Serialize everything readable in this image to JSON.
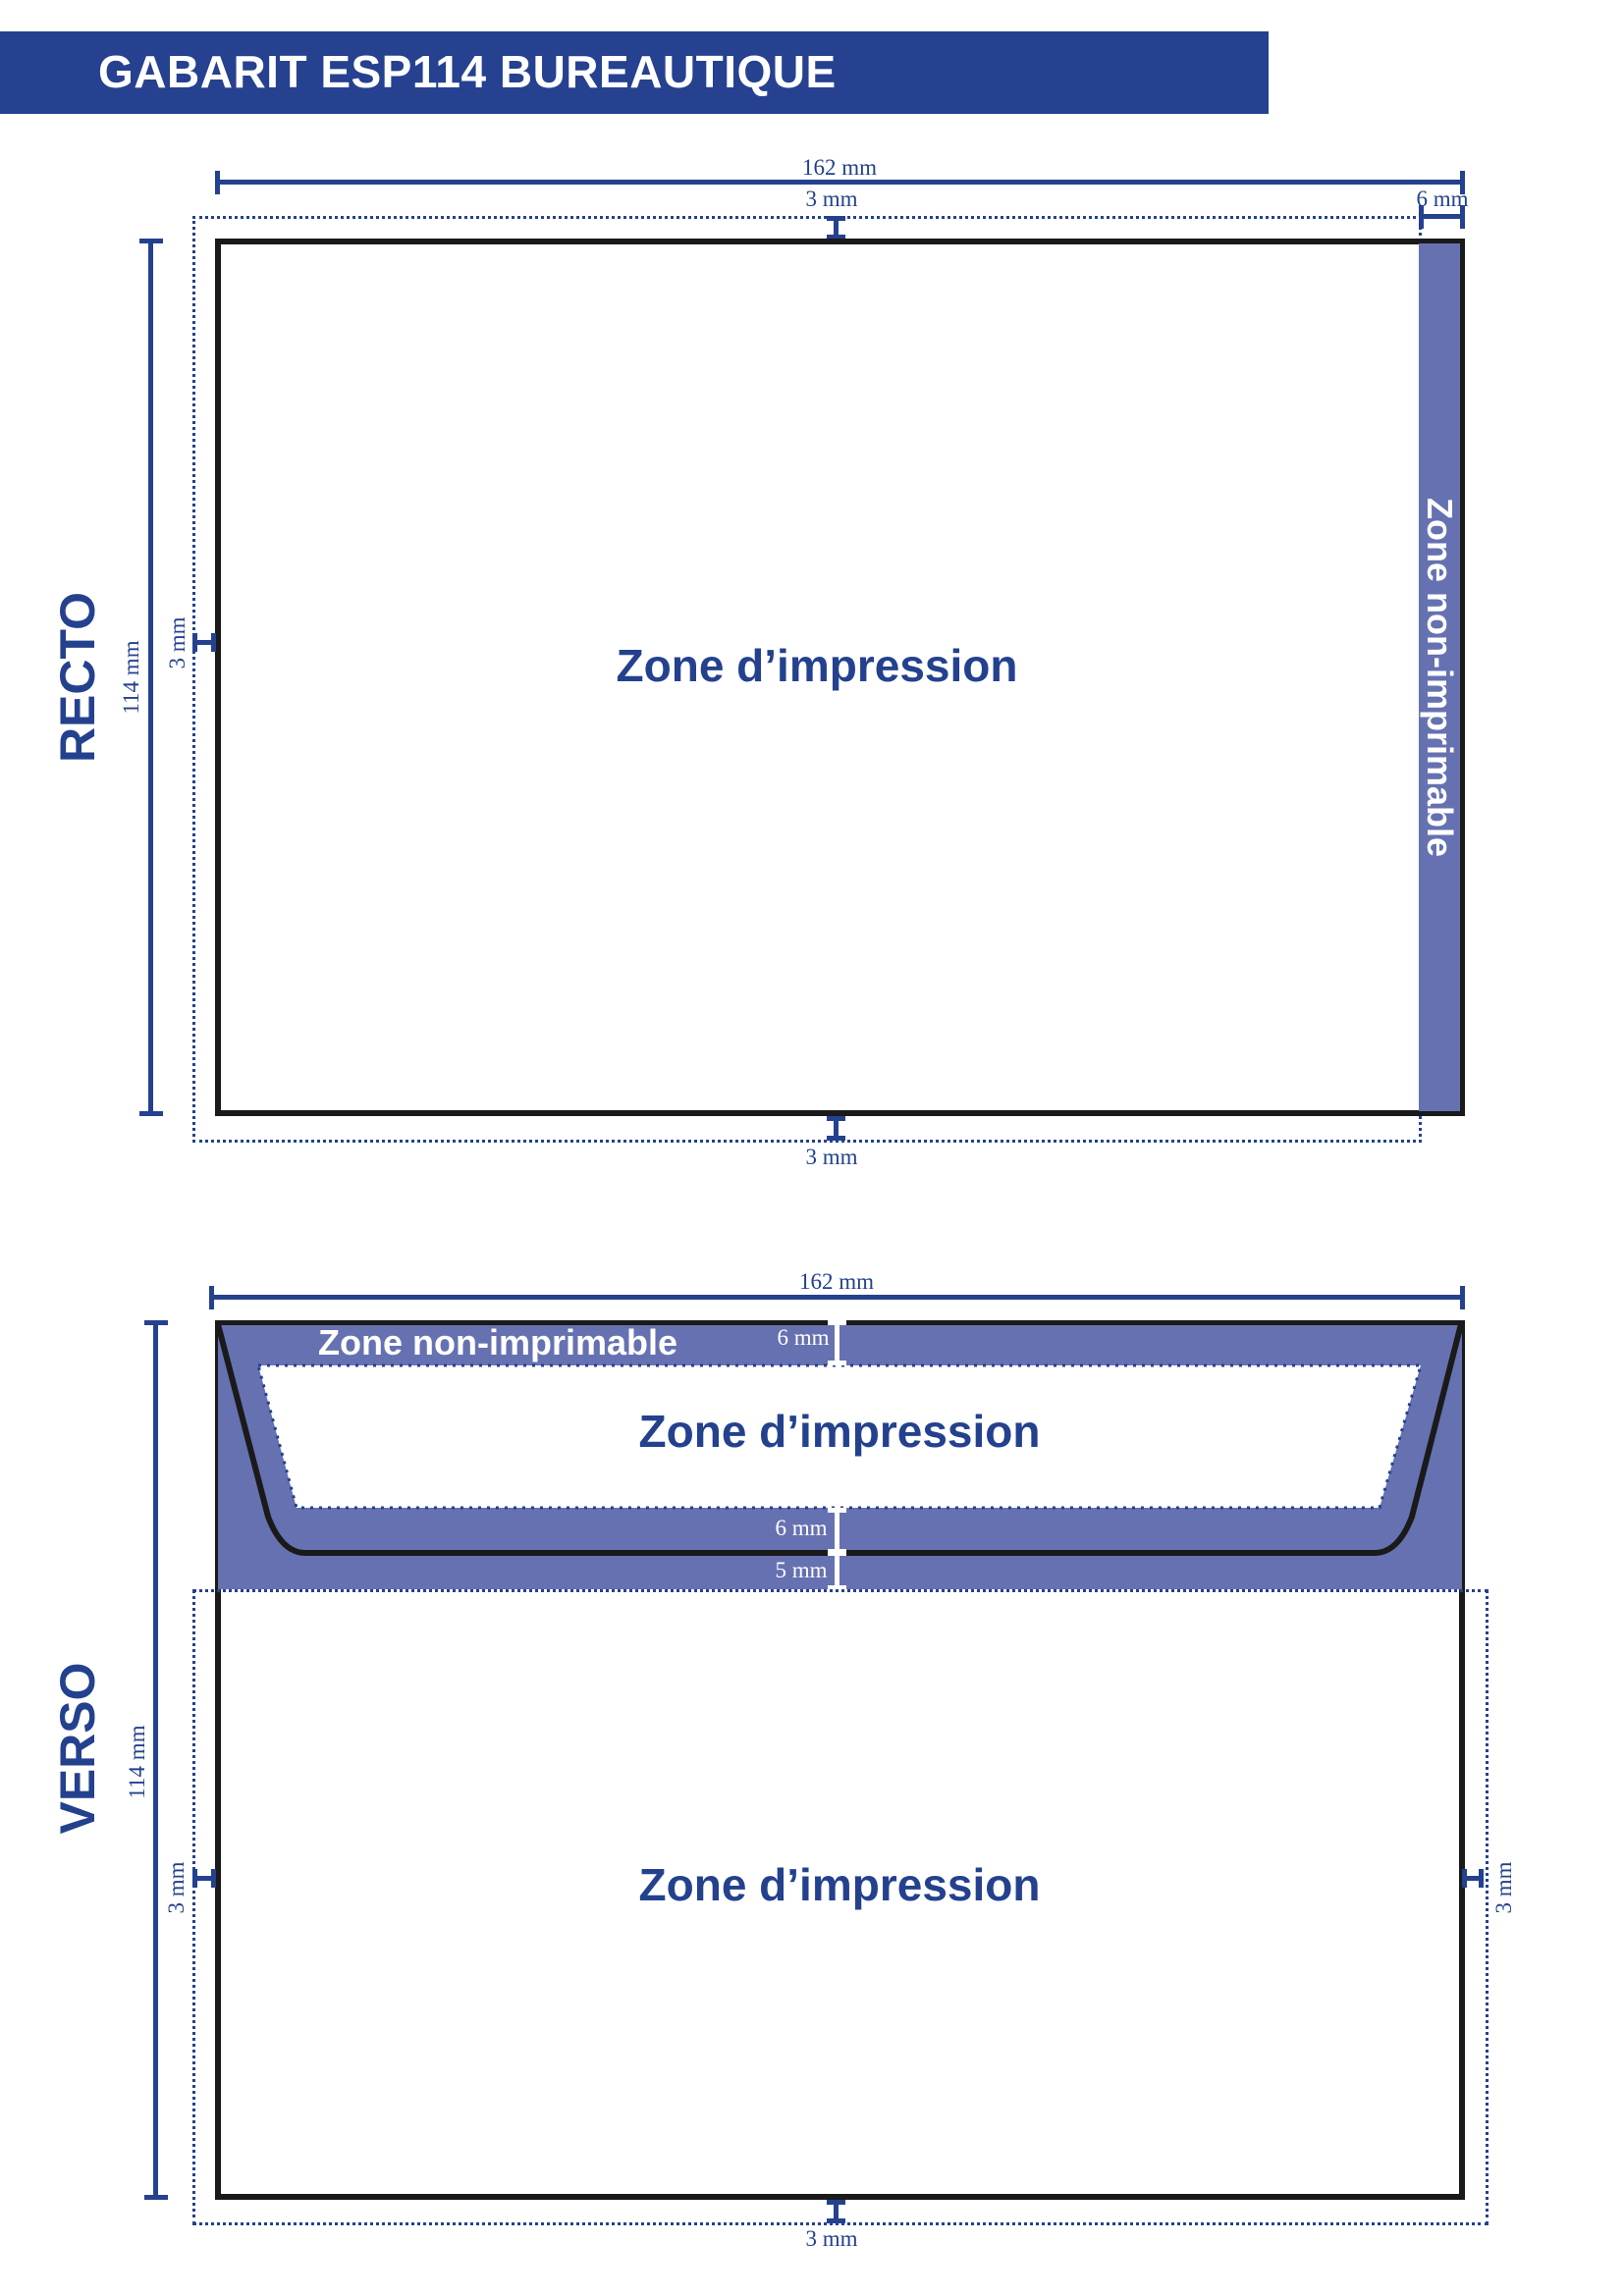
{
  "banner": {
    "title": "GABARIT ESP114 BUREAUTIQUE"
  },
  "colors": {
    "accent_blue": "#24418e",
    "banner_bg": "#25418f",
    "nonprint_purple": "#6671b1",
    "outline_black": "#1a1a1a",
    "label_white": "#ffffff"
  },
  "recto": {
    "side_label": "RECTO",
    "width_dim": "162 mm",
    "height_dim": "114 mm",
    "top_margin": "3 mm",
    "left_margin": "3 mm",
    "bottom_margin": "3 mm",
    "nonprint_width": "6 mm",
    "print_zone_label": "Zone d’impression",
    "nonprint_zone_label": "Zone non-imprimable"
  },
  "verso": {
    "side_label": "VERSO",
    "width_dim": "162 mm",
    "height_dim": "114 mm",
    "flap_nonprint_label": "Zone non-imprimable",
    "flap_top_margin": "6 mm",
    "flap_print_zone_label": "Zone d’impression",
    "flap_bottom_margin": "6 mm",
    "body_top_margin": "5 mm",
    "body_print_zone_label": "Zone d’impression",
    "left_margin": "3 mm",
    "right_margin": "3 mm",
    "bottom_margin": "3 mm"
  }
}
